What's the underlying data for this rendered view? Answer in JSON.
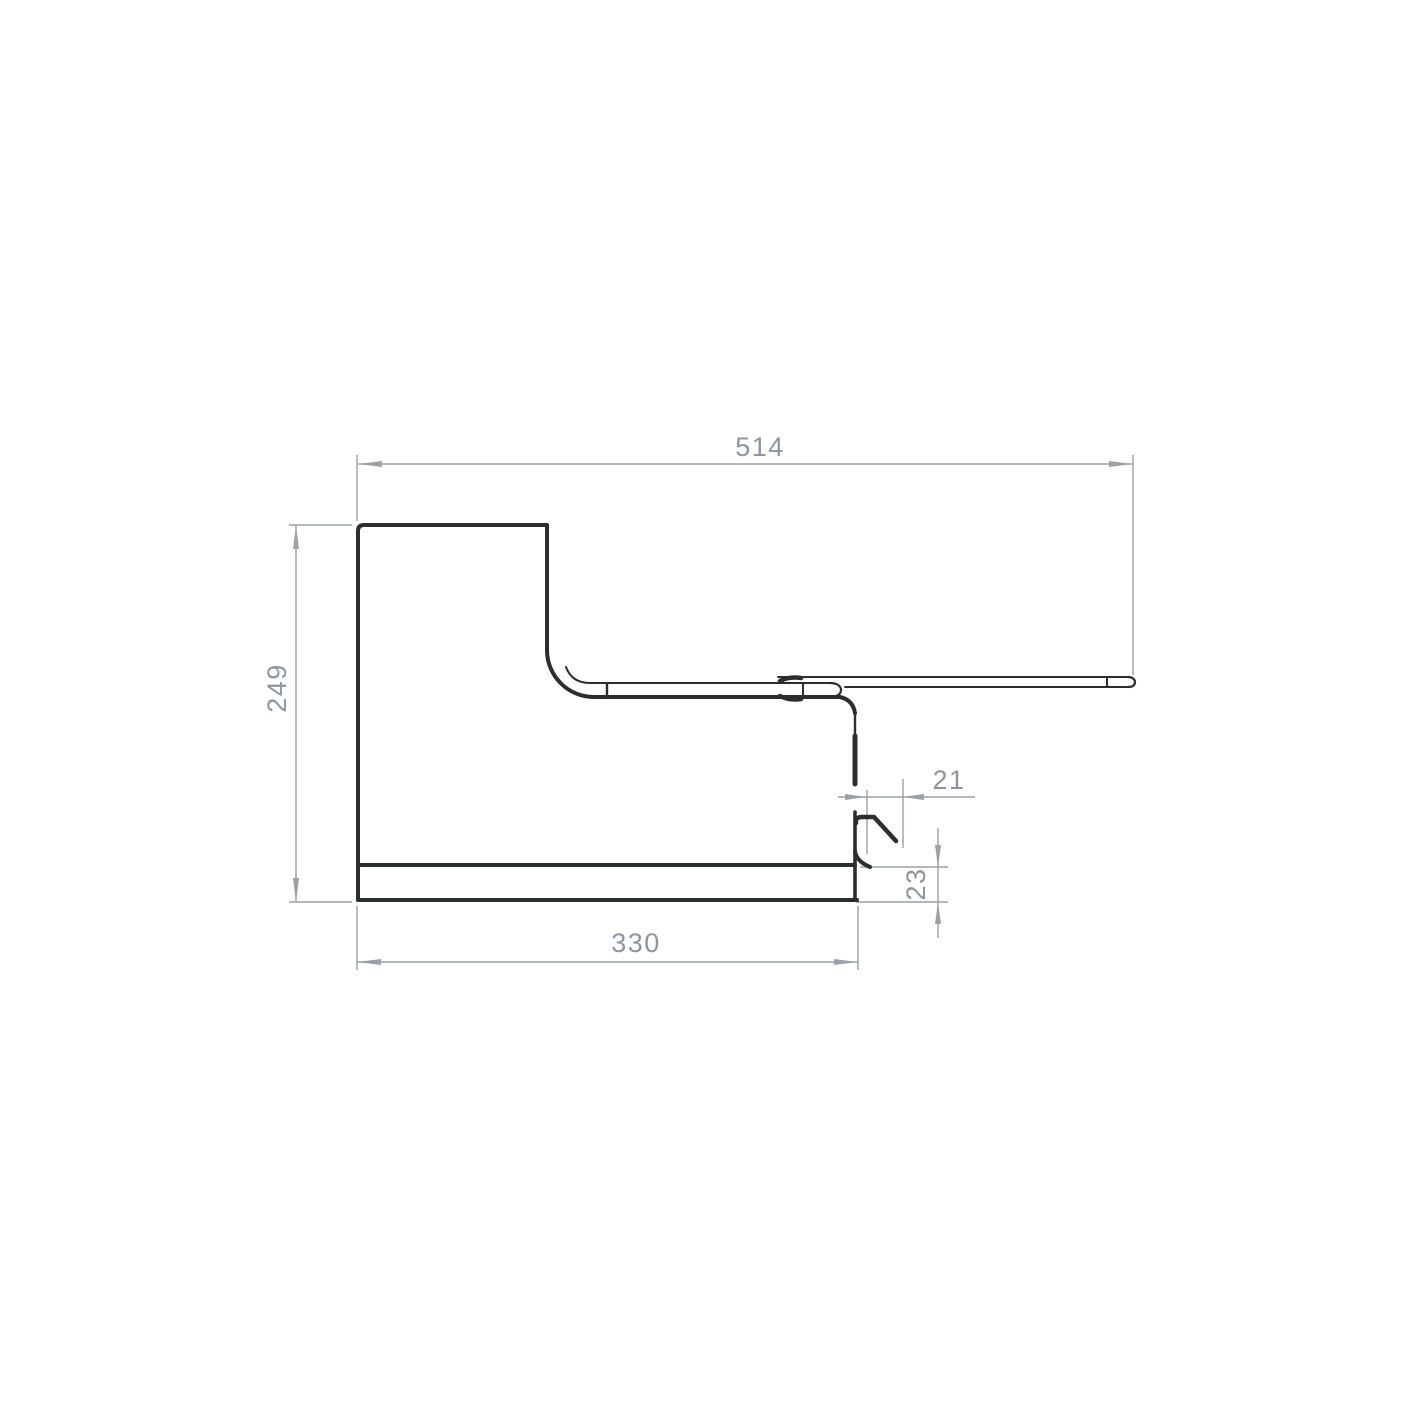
{
  "dimensions": {
    "top_width": "514",
    "left_height": "249",
    "bottom_width": "330",
    "hook_offset": "21",
    "base_height": "23"
  },
  "colors": {
    "outline": "#2b2e31",
    "dimension_lines": "#9aa0a6",
    "dimension_text": "#8c96a0",
    "background": "#ffffff"
  }
}
